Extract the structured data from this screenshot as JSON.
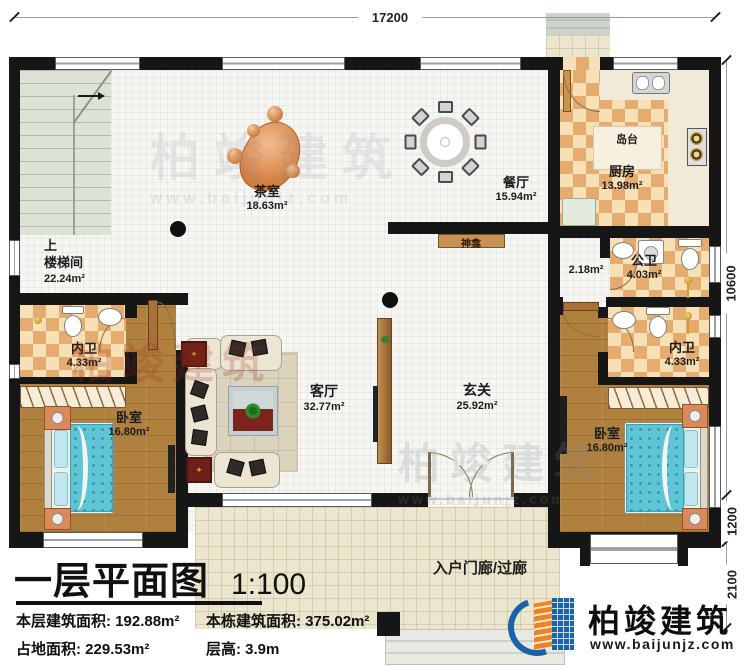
{
  "canvas": {
    "width": 750,
    "height": 667
  },
  "plan": {
    "dims": {
      "top": "17200",
      "right_total": "10600",
      "right_bay": "1200",
      "right_porch": "2100"
    },
    "rooms": {
      "tea": {
        "name": "茶室",
        "area": "18.63m²"
      },
      "dining": {
        "name": "餐厅",
        "area": "15.94m²"
      },
      "kitchen": {
        "name": "厨房",
        "area": "13.98m²"
      },
      "island": {
        "name": "岛台"
      },
      "shrine": {
        "name": "神龛"
      },
      "stair": {
        "up": "上",
        "name": "楼梯间",
        "area": "22.24m²"
      },
      "bath_left": {
        "name": "内卫",
        "area": "4.33m²"
      },
      "bath_public": {
        "name": "公卫",
        "area": "4.03m²"
      },
      "hallway": {
        "area": "2.18m²"
      },
      "bath_right": {
        "name": "内卫",
        "area": "4.33m²"
      },
      "bedroom_left": {
        "name": "卧室",
        "area": "16.80m²"
      },
      "bedroom_right": {
        "name": "卧室",
        "area": "16.80m²"
      },
      "living": {
        "name": "客厅",
        "area": "32.77m²"
      },
      "foyer": {
        "name": "玄关",
        "area": "25.92m²"
      },
      "porch": {
        "name": "入户门廊/过廊"
      }
    }
  },
  "title_block": {
    "title": "一层平面图",
    "scale": "1:100",
    "stats": [
      {
        "label": "本层建筑面积:",
        "value": "192.88m²"
      },
      {
        "label": "本栋建筑面积:",
        "value": "375.02m²"
      },
      {
        "label": "占地面积:",
        "value": "229.53m²"
      },
      {
        "label": "层高:",
        "value": "3.9m"
      }
    ]
  },
  "brand": {
    "name": "柏竣建筑",
    "website": "www.baijunjz.com"
  },
  "watermark": {
    "text": "柏竣建筑",
    "sub": "www.baijunjz.com"
  },
  "colors": {
    "wall": "#161616",
    "checker_dark": "#e5ab6f",
    "checker_light": "#f7dfb6",
    "wood": "#b0803f",
    "bed_blue": "#5ec5d6",
    "porch": "#ebe6cd",
    "brand_blue": "#1b63a9",
    "brand_orange": "#f08222"
  }
}
